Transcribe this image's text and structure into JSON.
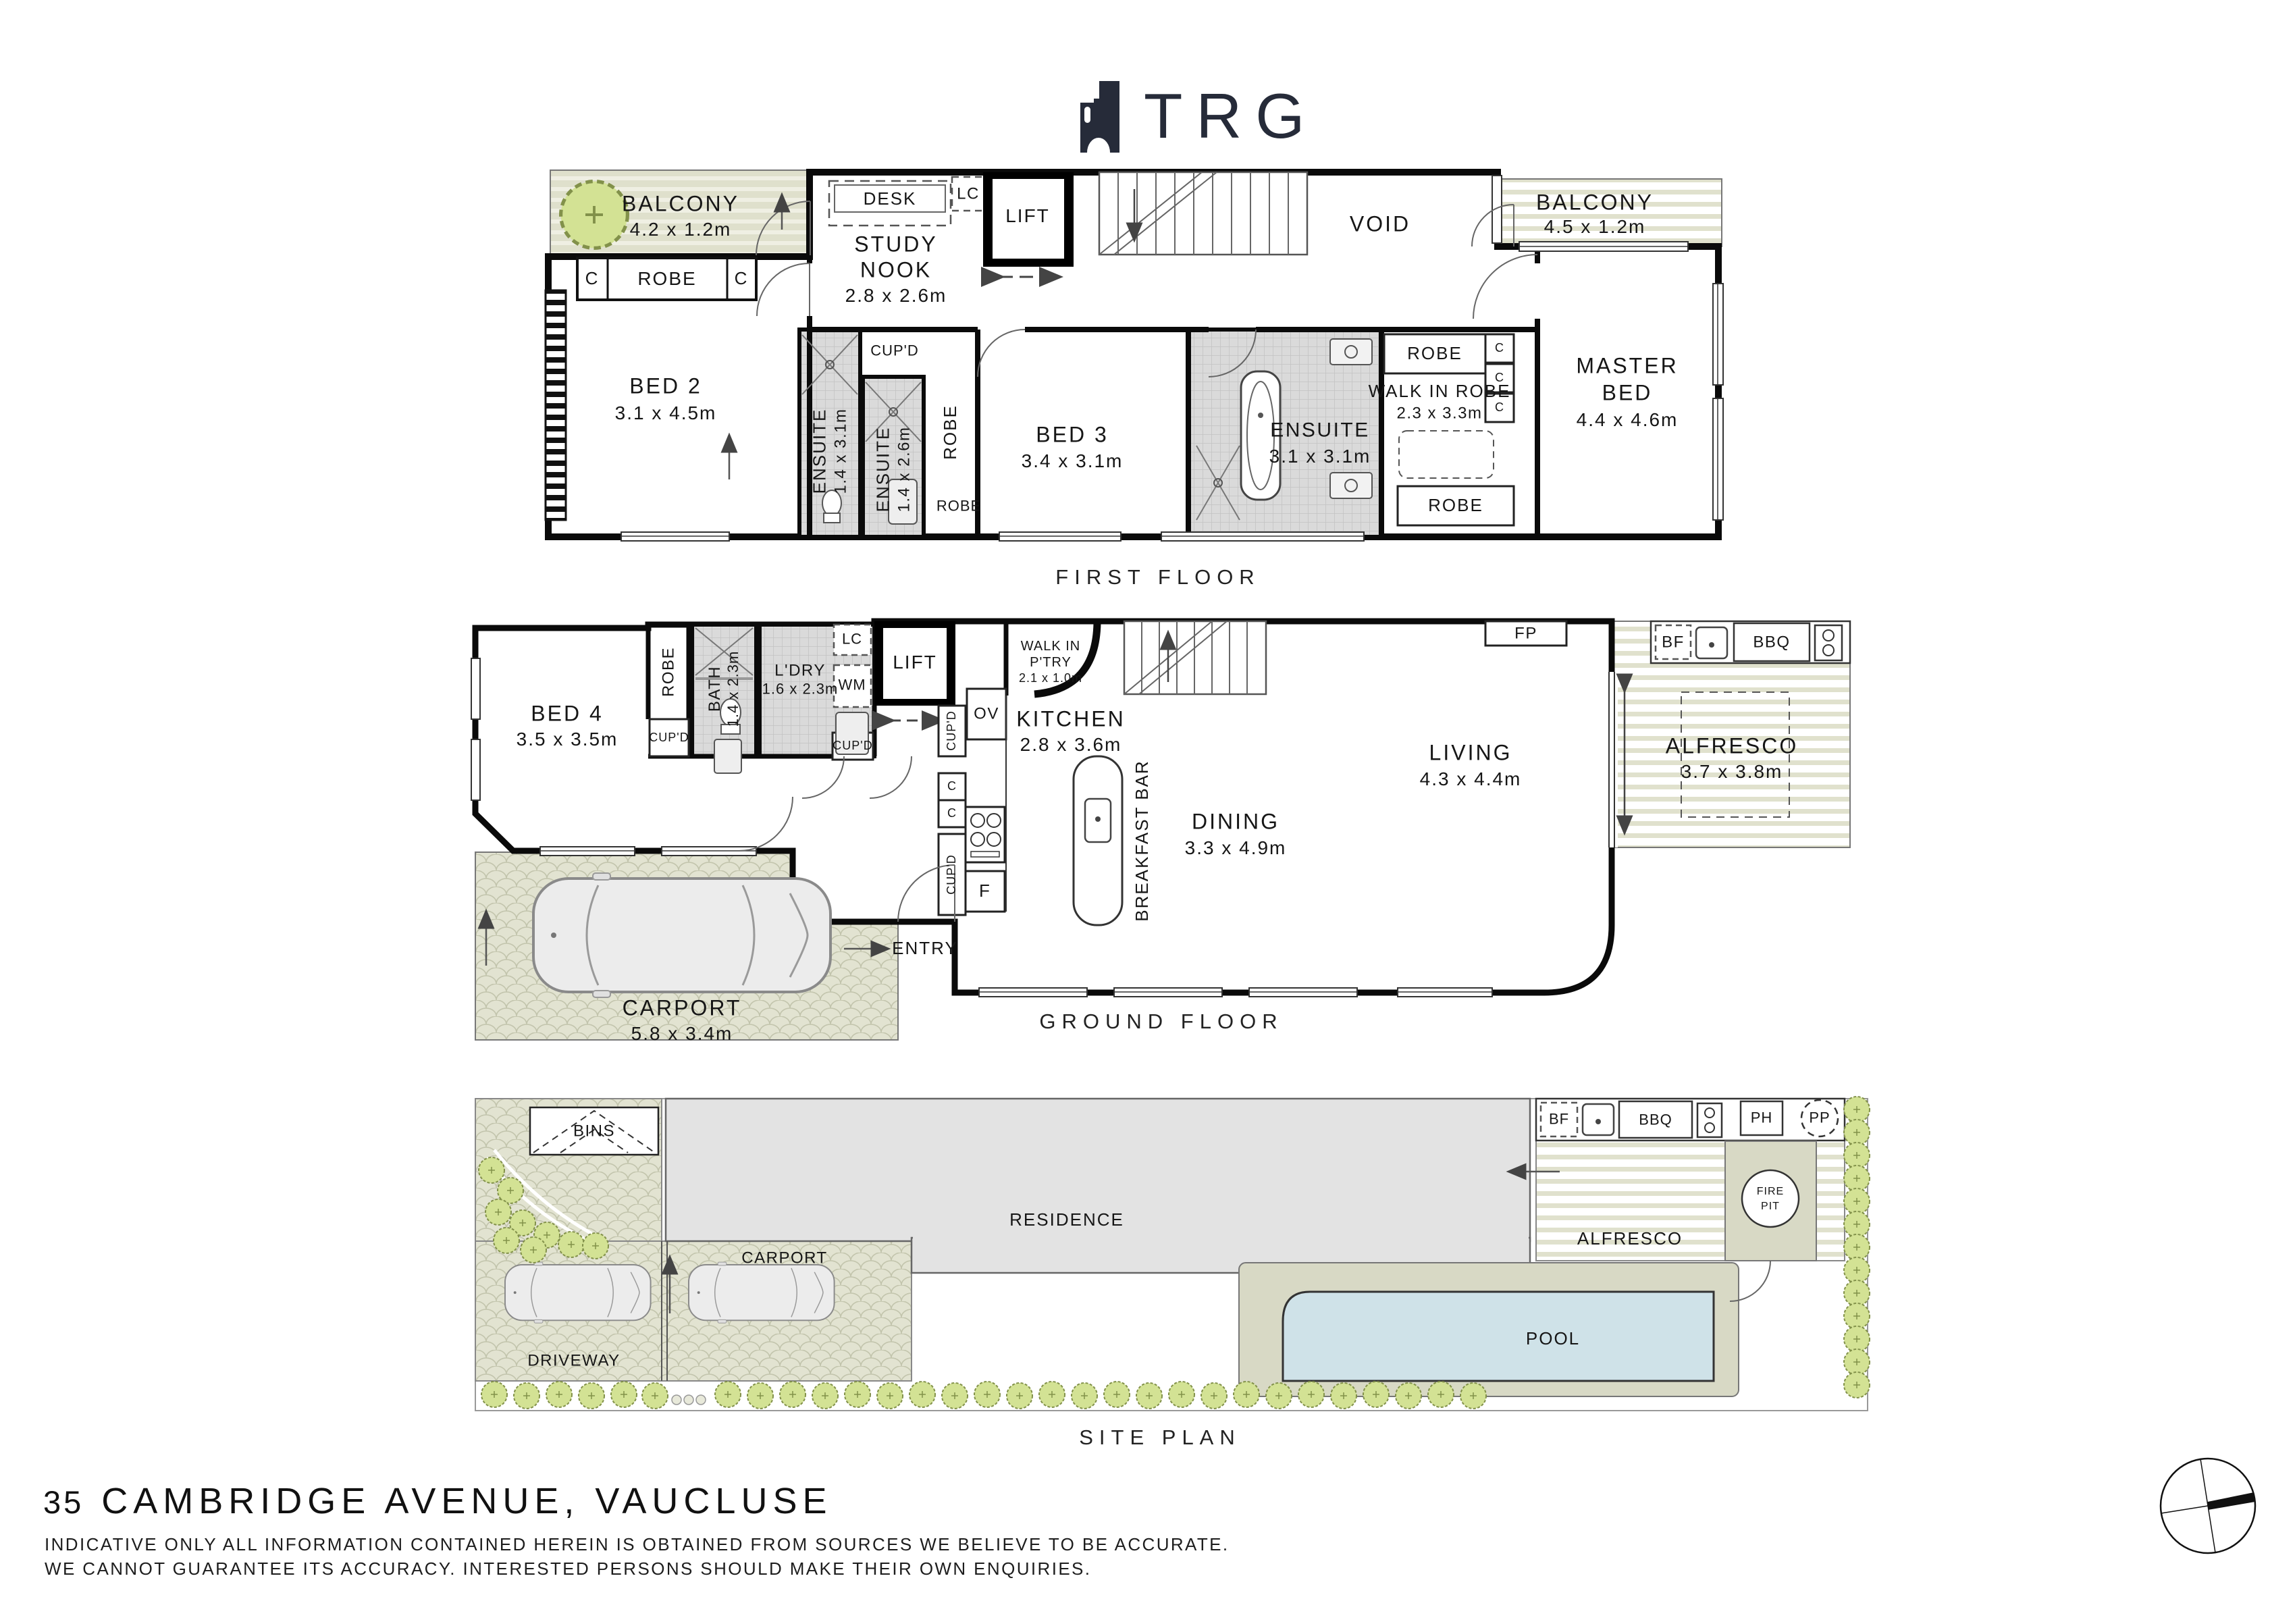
{
  "logo": {
    "text": "TRG"
  },
  "first": {
    "title": "FIRST FLOOR",
    "balcony_left": "BALCONY",
    "balcony_left_dims": "4.2 x 1.2m",
    "c1": "C",
    "robe1": "ROBE",
    "c2": "C",
    "bed2": "BED 2",
    "bed2_dims": "3.1 x 4.5m",
    "ensuite1": "ENSUITE",
    "ensuite1_dims": "1.4 x 3.1m",
    "cupd": "CUP'D",
    "ensuite2": "ENSUITE",
    "ensuite2_dims": "1.4 x 2.6m",
    "robe_vert": "ROBE",
    "robe_small": "ROBE",
    "desk": "DESK",
    "lc": "LC",
    "study1": "STUDY",
    "study2": "NOOK",
    "study_dims": "2.8 x 2.6m",
    "lift": "LIFT",
    "void": "VOID",
    "balcony_right": "BALCONY",
    "balcony_right_dims": "4.5 x 1.2m",
    "bed3": "BED 3",
    "bed3_dims": "3.4 x 3.1m",
    "ensuite3": "ENSUITE",
    "ensuite3_dims": "3.1 x 3.1m",
    "robe_top": "ROBE",
    "c3": "C",
    "c4": "C",
    "c5": "C",
    "wir": "WALK IN ROBE",
    "wir_dims": "2.3 x 3.3m",
    "robe_bottom": "ROBE",
    "master1": "MASTER",
    "master2": "BED",
    "master_dims": "4.4 x 4.6m"
  },
  "ground": {
    "title": "GROUND FLOOR",
    "bed4": "BED 4",
    "bed4_dims": "3.5 x 3.5m",
    "robe": "ROBE",
    "cupd_a": "CUP'D",
    "bath": "BATH",
    "bath_dims": "1.4 x 2.3m",
    "ldry": "L'DRY",
    "ldry_dims": "1.6 x 2.3m",
    "lc": "LC",
    "wm": "WM",
    "cupd_b": "CUP'D",
    "lift": "LIFT",
    "cupd_c": "CUP'D",
    "c1": "C",
    "c2": "C",
    "cupd_d": "CUP'D",
    "ov": "OV",
    "f": "F",
    "wip1": "WALK IN",
    "wip2": "P'TRY",
    "wip_dims": "2.1 x 1.0m",
    "kitchen": "KITCHEN",
    "kitchen_dims": "2.8 x 3.6m",
    "breakfast_bar": "BREAKFAST BAR",
    "dining": "DINING",
    "dining_dims": "3.3 x 4.9m",
    "living": "LIVING",
    "living_dims": "4.3 x 4.4m",
    "fp": "FP",
    "bf": "BF",
    "bbq": "BBQ",
    "alfresco": "ALFRESCO",
    "alfresco_dims": "3.7 x 3.8m",
    "carport": "CARPORT",
    "carport_dims": "5.8 x 3.4m",
    "entry": "ENTRY"
  },
  "site": {
    "title": "SITE PLAN",
    "bins": "BINS",
    "residence": "RESIDENCE",
    "carport": "CARPORT",
    "driveway": "DRIVEWAY",
    "pool": "POOL",
    "alfresco": "ALFRESCO",
    "fire1": "FIRE",
    "fire2": "PIT",
    "bf": "BF",
    "bbq": "BBQ",
    "ph": "PH",
    "pp": "PP"
  },
  "footer": {
    "number": "35",
    "address": "CAMBRIDGE AVENUE, VAUCLUSE",
    "disclaimer1": "INDICATIVE ONLY ALL INFORMATION CONTAINED HEREIN IS OBTAINED FROM SOURCES WE BELIEVE TO BE ACCURATE.",
    "disclaimer2": "WE CANNOT GUARANTEE ITS ACCURACY. INTERESTED PERSONS SHOULD MAKE THEIR OWN ENQUIRIES."
  }
}
